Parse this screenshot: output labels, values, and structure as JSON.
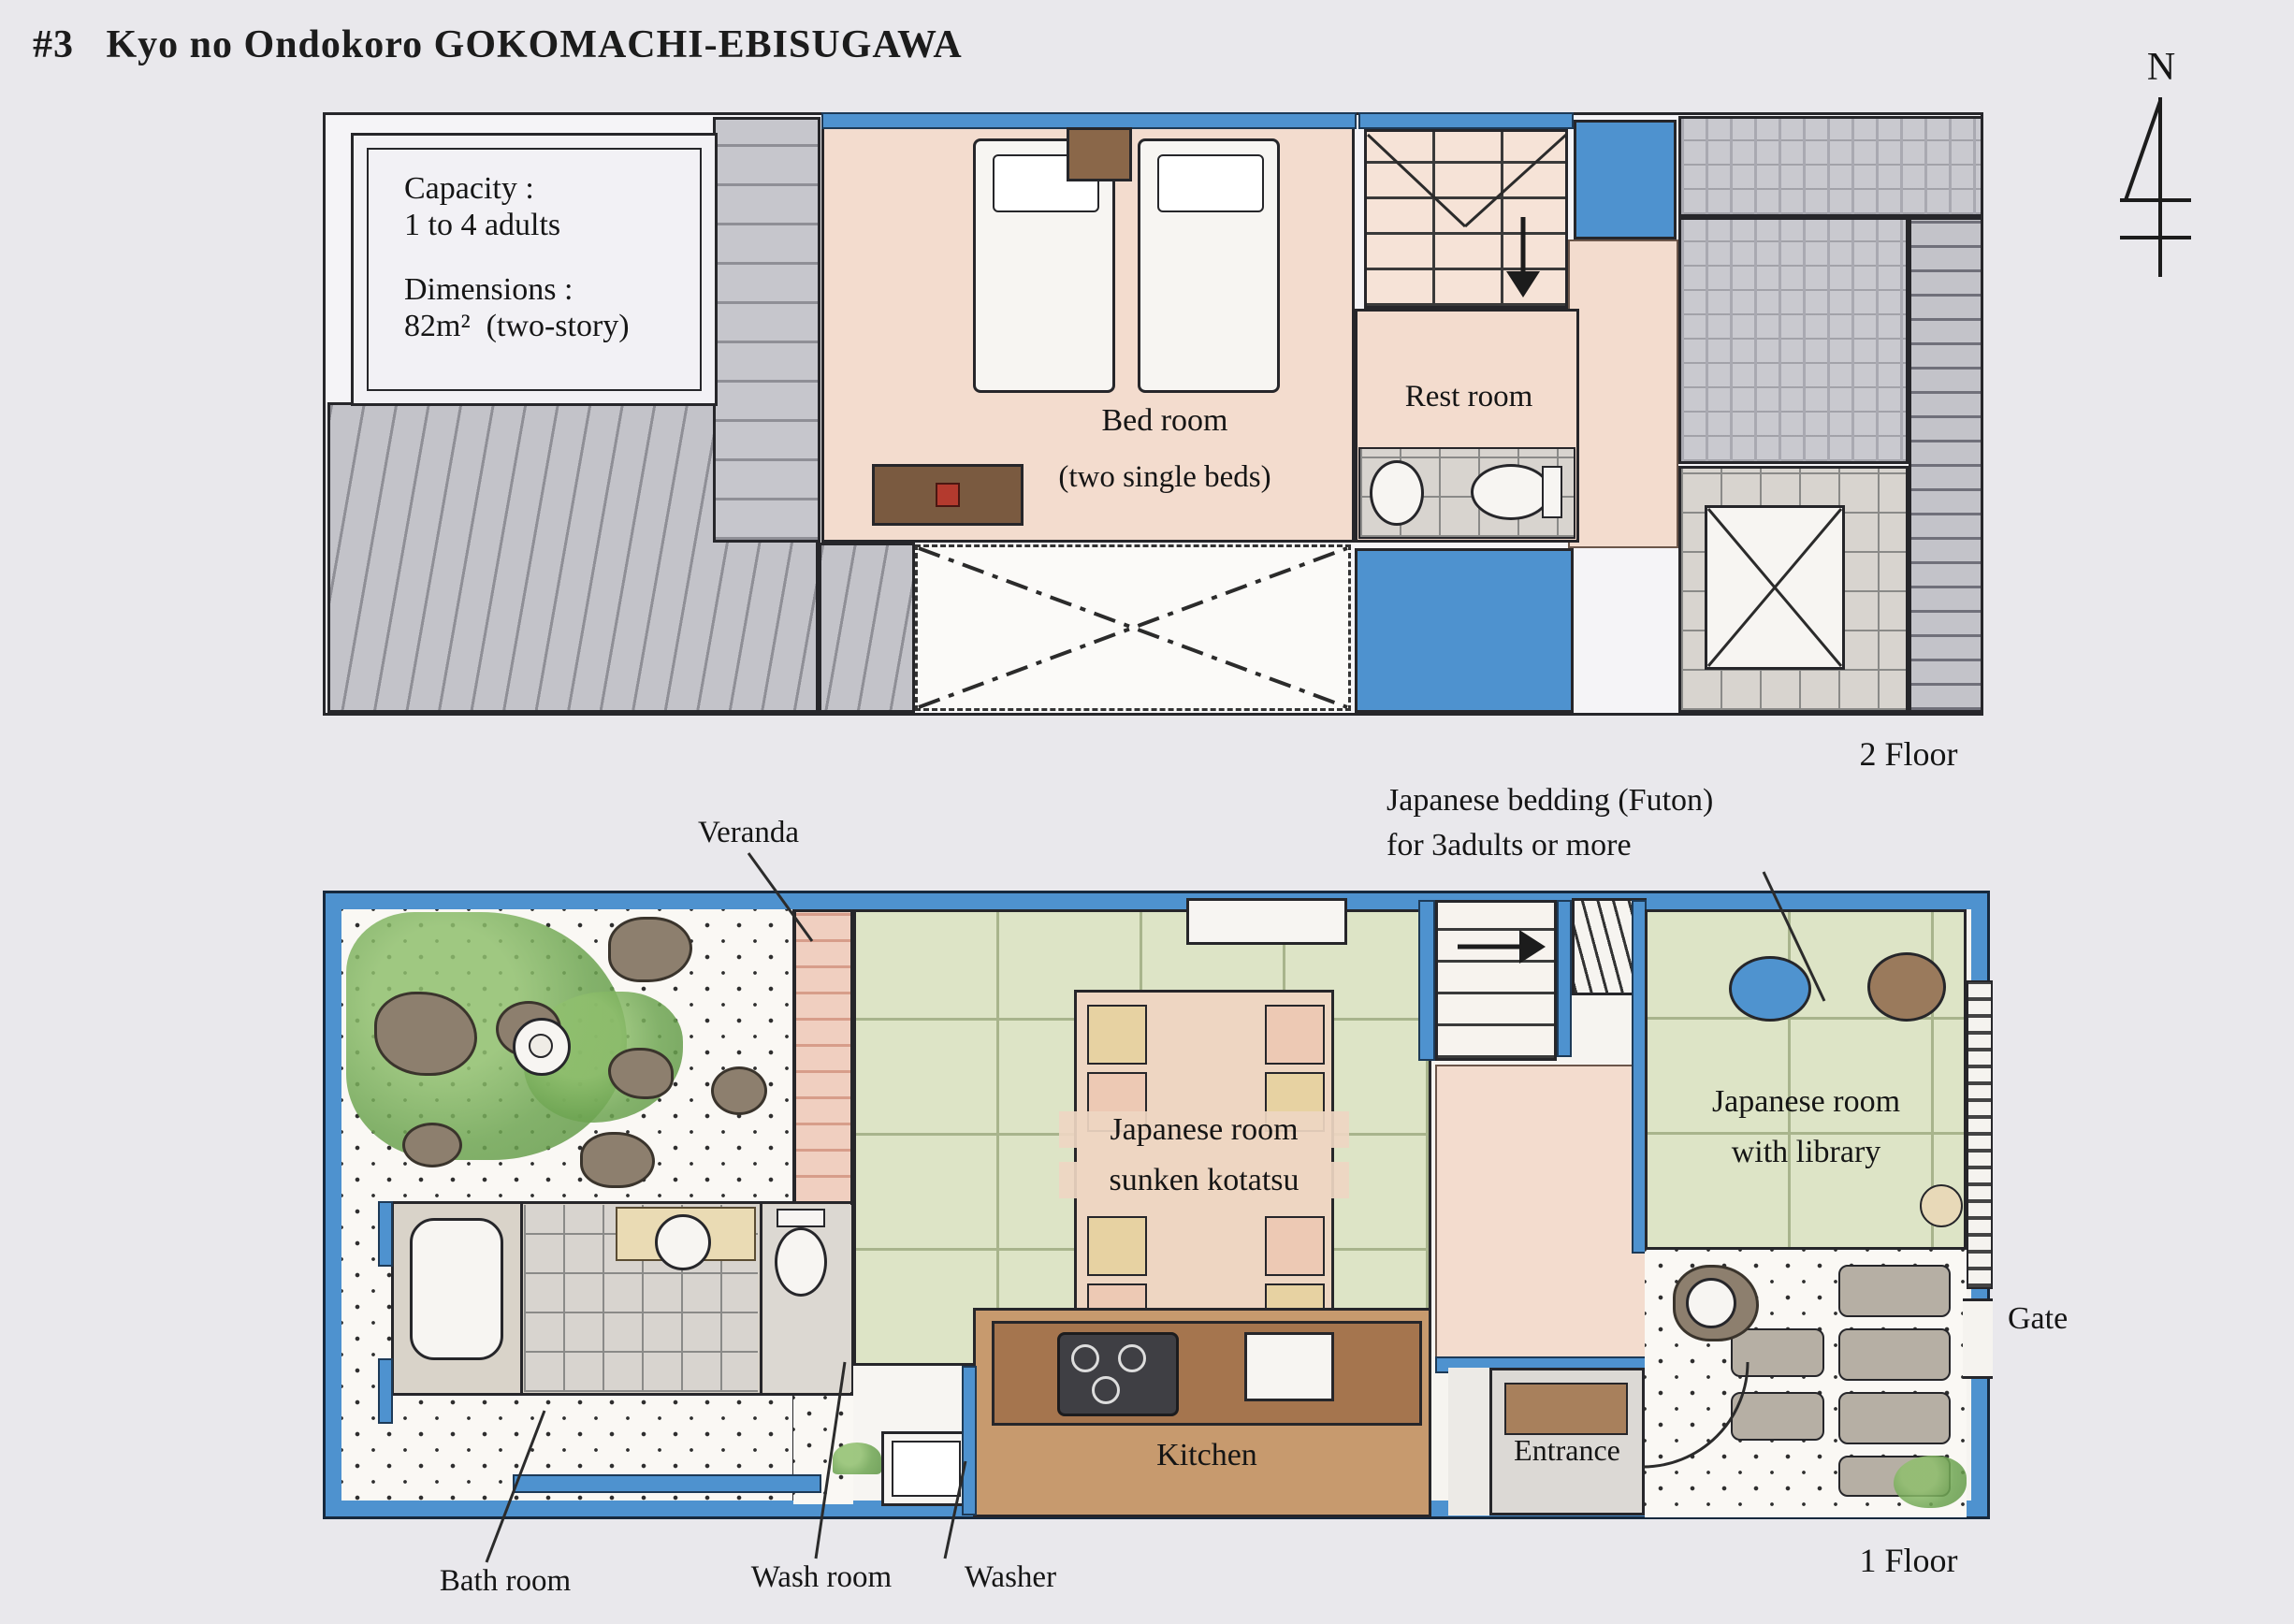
{
  "title": "#3   Kyo no Ondokoro GOKOMACHI-EBISUGAWA",
  "compass": {
    "north": "N"
  },
  "info_box": {
    "capacity_label": "Capacity :",
    "capacity_value": "1 to 4 adults",
    "dimensions_label": "Dimensions :",
    "dimensions_value": "82m²  (two-story)"
  },
  "floor2": {
    "bedroom_name": "Bed room",
    "bedroom_note": "(two single beds)",
    "restroom": "Rest room",
    "floor_label": "2 Floor"
  },
  "floor1": {
    "veranda": "Veranda",
    "futon_note_1": "Japanese bedding (Futon)",
    "futon_note_2": "for 3adults or more",
    "kotatsu_room_1": "Japanese room",
    "kotatsu_room_2": "sunken kotatsu",
    "library_room_1": "Japanese room",
    "library_room_2": "with library",
    "kitchen": "Kitchen",
    "entrance": "Entrance",
    "gate": "Gate",
    "bath": "Bath room",
    "wash": "Wash room",
    "washer": "Washer",
    "floor_label": "1 Floor"
  },
  "colors": {
    "wall_blue": "#4e92cf",
    "room_pink": "#f3dcce",
    "tatami_green": "#dde4c6",
    "kitchen_brown": "#c79a6e",
    "background": "#e9e8ec"
  }
}
